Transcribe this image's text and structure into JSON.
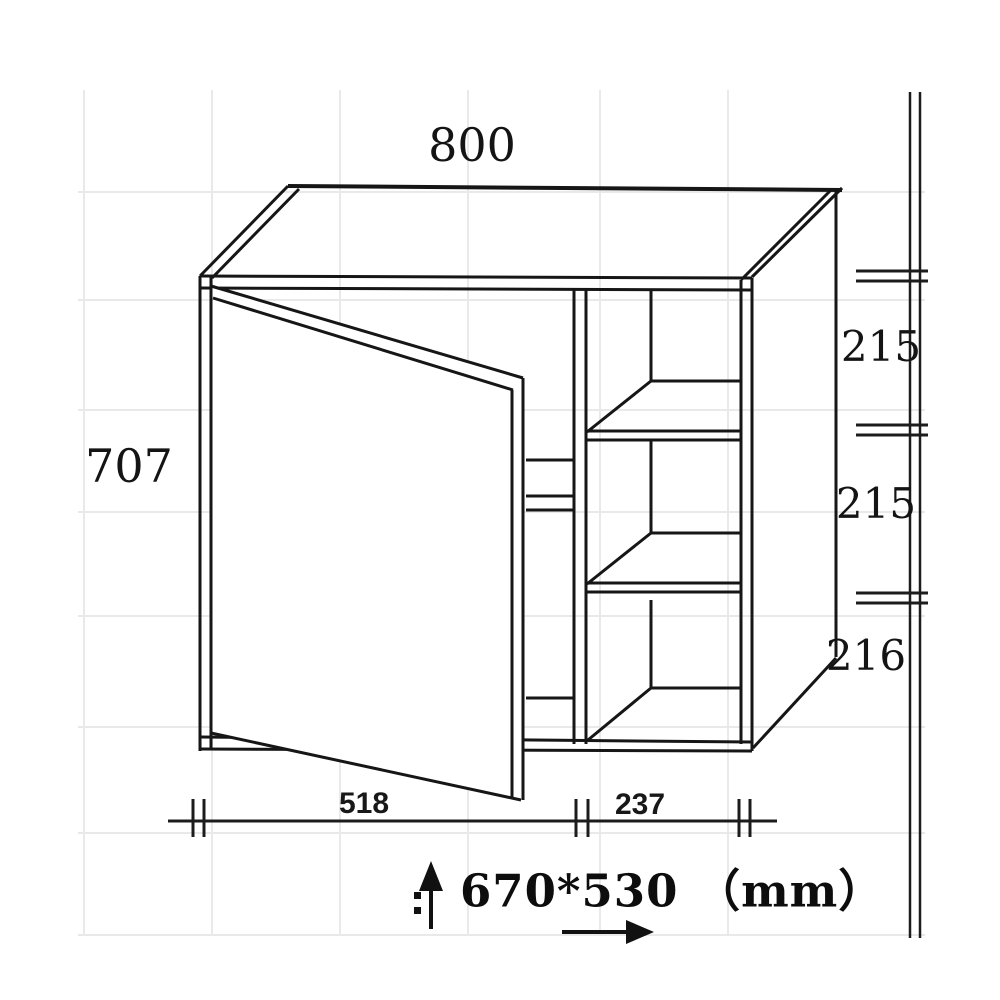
{
  "diagram": {
    "kind": "furniture-dimension-drawing",
    "object": "wall cabinet with open left door and two shelves in right compartment",
    "units": "mm",
    "colors": {
      "line": "#161616",
      "grid": "#e9e9e9",
      "text": "#141414",
      "background": "#ffffff"
    },
    "dimensions": {
      "top_width": {
        "value": "800"
      },
      "left_height": {
        "value": "707"
      },
      "right_segments": [
        {
          "value": "215"
        },
        {
          "value": "215"
        },
        {
          "value": "216"
        }
      ],
      "bottom_segments": [
        {
          "value": "518"
        },
        {
          "value": "237"
        }
      ],
      "size_note": {
        "value": "670*530 （mm）"
      }
    }
  }
}
